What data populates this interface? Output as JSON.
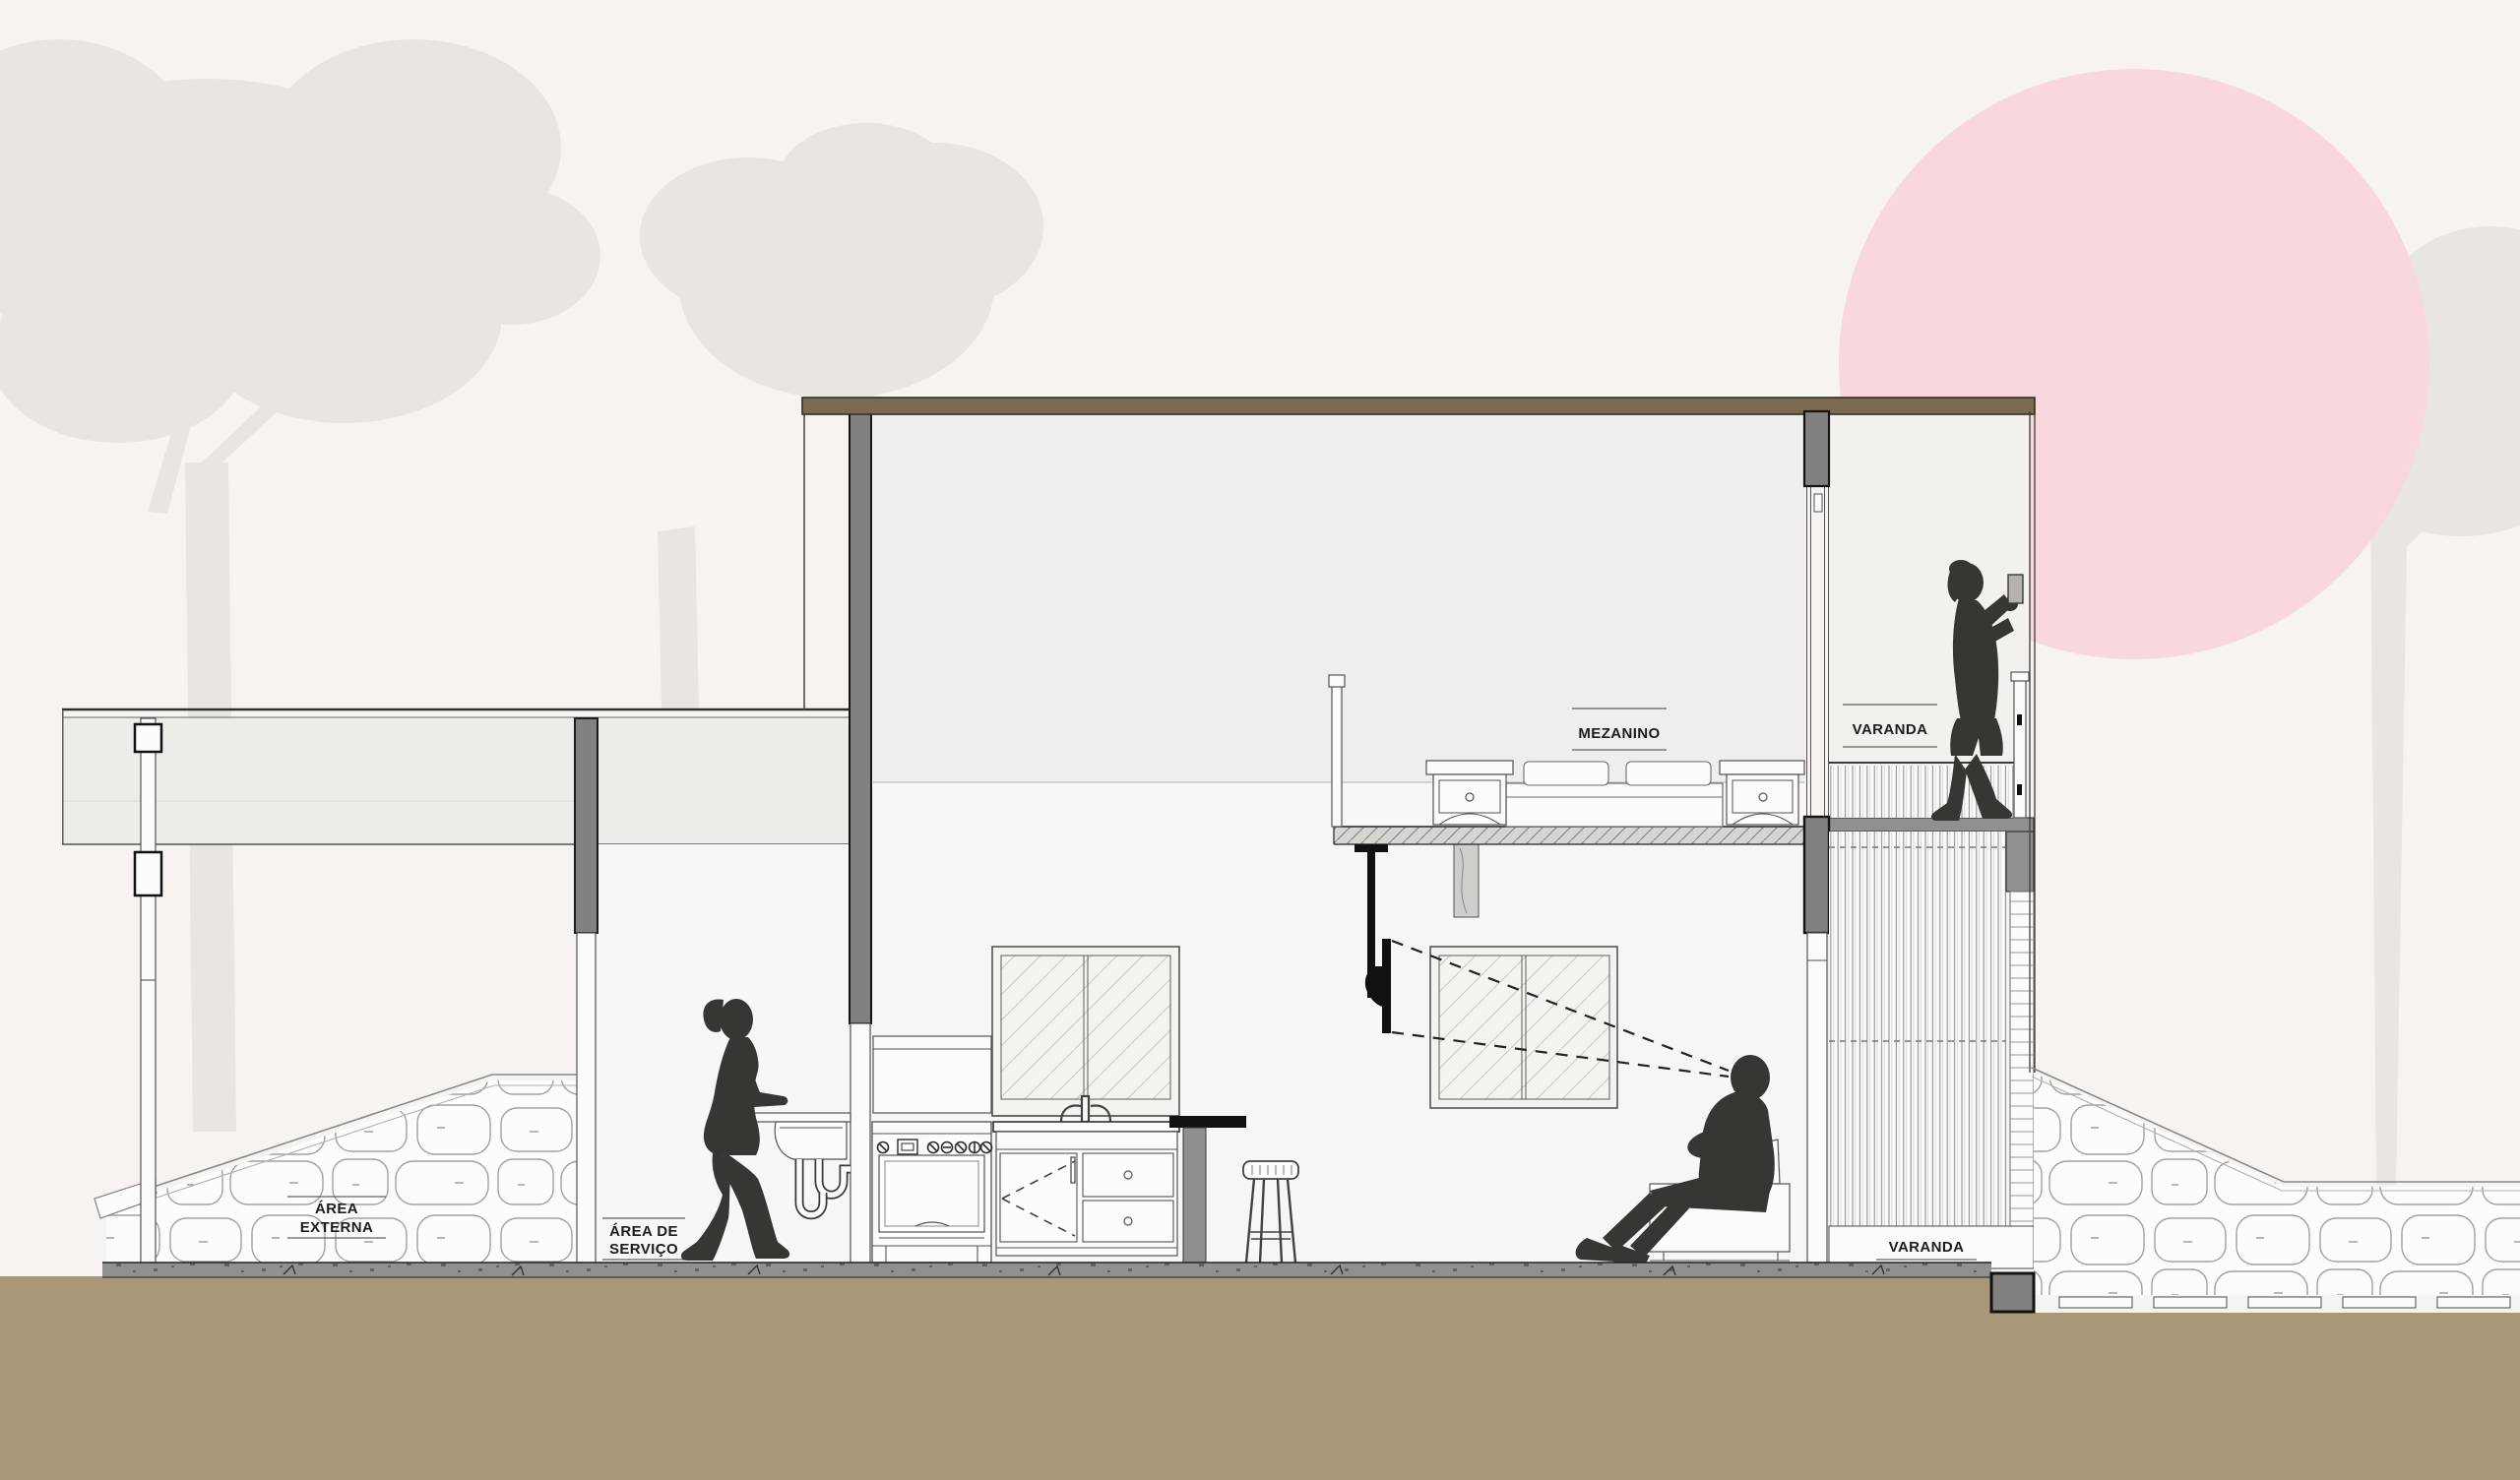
{
  "labels": {
    "area_externa_line1": "ÁREA",
    "area_externa_line2": "EXTERNA",
    "area_servico_line1": "ÁREA DE",
    "area_servico_line2": "SERVIÇO",
    "mezanino": "MEZANINO",
    "varanda_upper": "VARANDA",
    "varanda_lower": "VARANDA"
  },
  "colors": {
    "background": "#f7f3f0",
    "roof_brown": "#7b6951",
    "ground_brown": "#a89878",
    "slab_gray": "#90908e",
    "column_gray": "#82817f",
    "upper_wall_gray": "#efeeec",
    "interior_white": "#f7f6f4",
    "varanda_wall": "#f2f1ee",
    "sun_pink": "#f8d7dd",
    "tree_silhouette": "#e9e5e2",
    "figure_dark": "#383633",
    "stone_line": "#a3a19d",
    "line_dark": "#33312d",
    "panel_white": "#fbfbfa"
  }
}
